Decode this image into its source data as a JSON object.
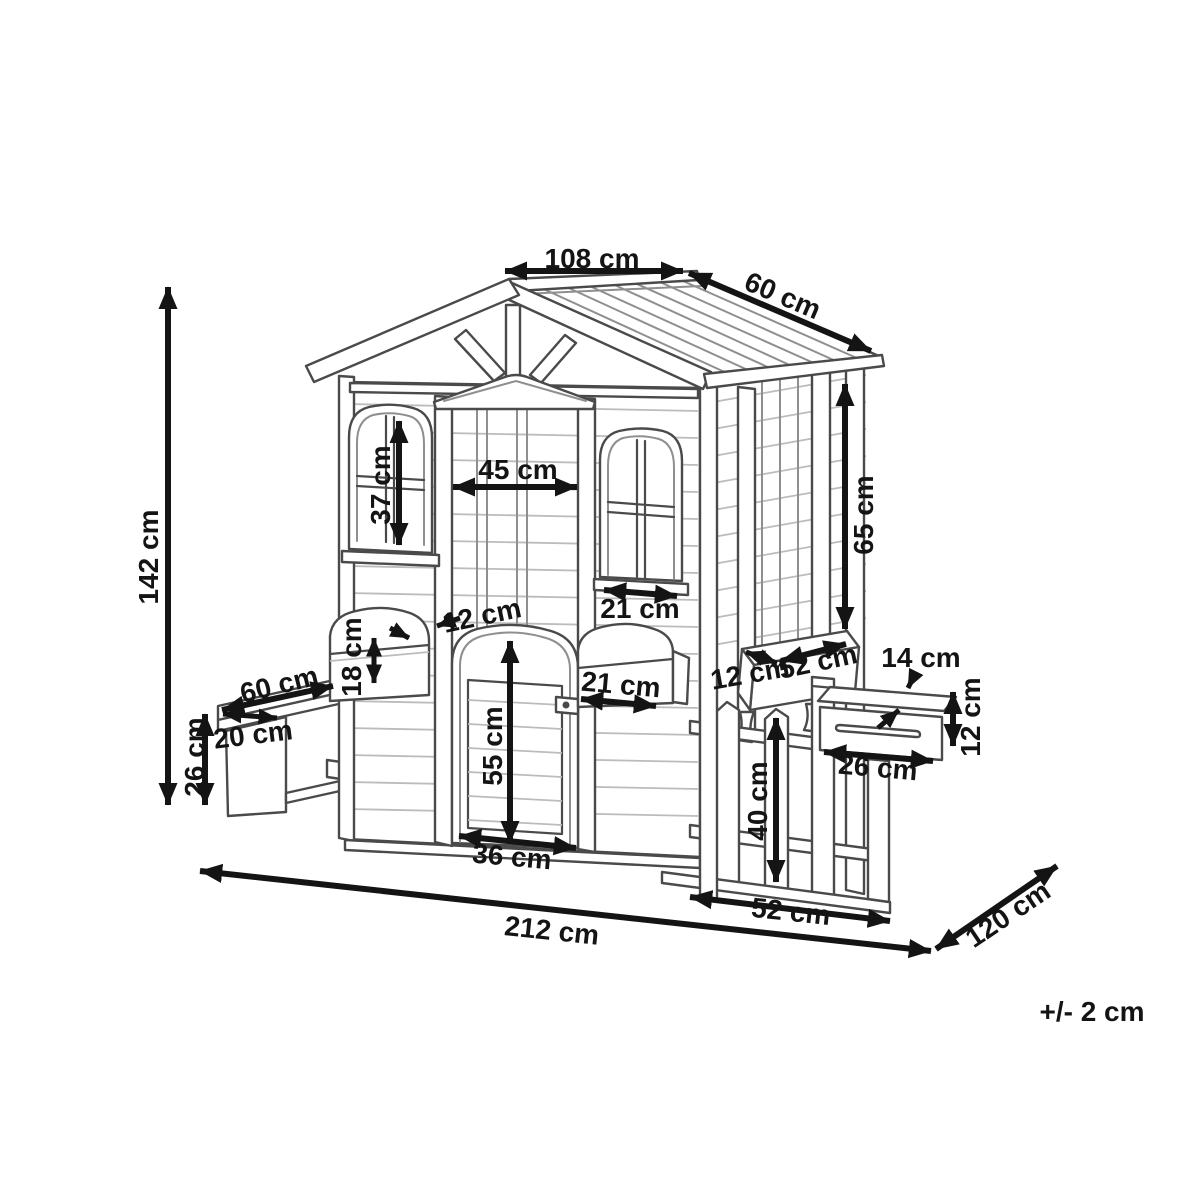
{
  "page": {
    "background_color": "#ffffff"
  },
  "drawing": {
    "subject": "wooden playhouse dimensional line drawing",
    "style": "monochrome technical illustration with double-headed dimension arrows",
    "unit": "cm",
    "line_color": "#4a4a4a",
    "dimension_color": "#141414"
  },
  "labels": {
    "ridge_length": "108 cm",
    "roof_depth": "60 cm",
    "total_height": "142 cm",
    "front_window_height": "37 cm",
    "door_frame_width": "45 cm",
    "side_window_width": "21 cm",
    "door_planter_depth": "12 cm",
    "front_planter_height": "18 cm",
    "bench_length": "60 cm",
    "bench_depth": "20 cm",
    "bench_height": "26 cm",
    "door_planter_width": "21 cm",
    "door_height": "55 cm",
    "door_width": "36 cm",
    "porch_opening_height": "65 cm",
    "porch_planter_depth": "12 cm",
    "porch_planter_length": "52 cm",
    "mailbox_depth": "14 cm",
    "mailbox_height": "12 cm",
    "mailbox_length": "26 cm",
    "fence_height": "40 cm",
    "fence_length": "52 cm",
    "total_width": "212 cm",
    "total_depth": "120 cm",
    "tolerance": "+/- 2 cm"
  }
}
